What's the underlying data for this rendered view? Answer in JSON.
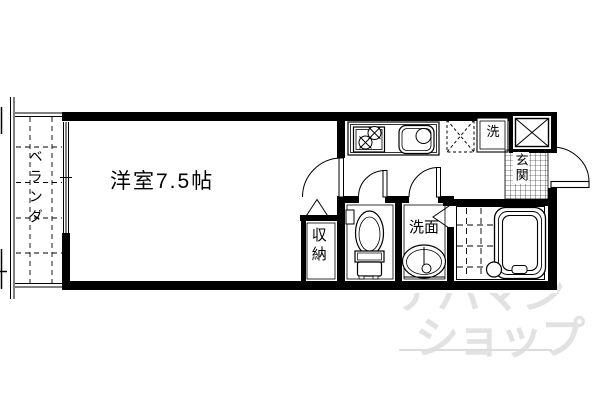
{
  "rooms": {
    "main": {
      "label": "洋室7.5帖"
    },
    "balcony": {
      "label": "ベランダ"
    },
    "closet": {
      "label": "収納"
    },
    "washroom": {
      "label": "洗面"
    },
    "laundry": {
      "label": "洗"
    },
    "entrance": {
      "label": "玄関"
    }
  },
  "watermark": {
    "line1": "アパマン",
    "line2": "ショップ"
  },
  "colors": {
    "wall": "#000000",
    "background": "#ffffff",
    "watermark": "#e2e2e2"
  }
}
